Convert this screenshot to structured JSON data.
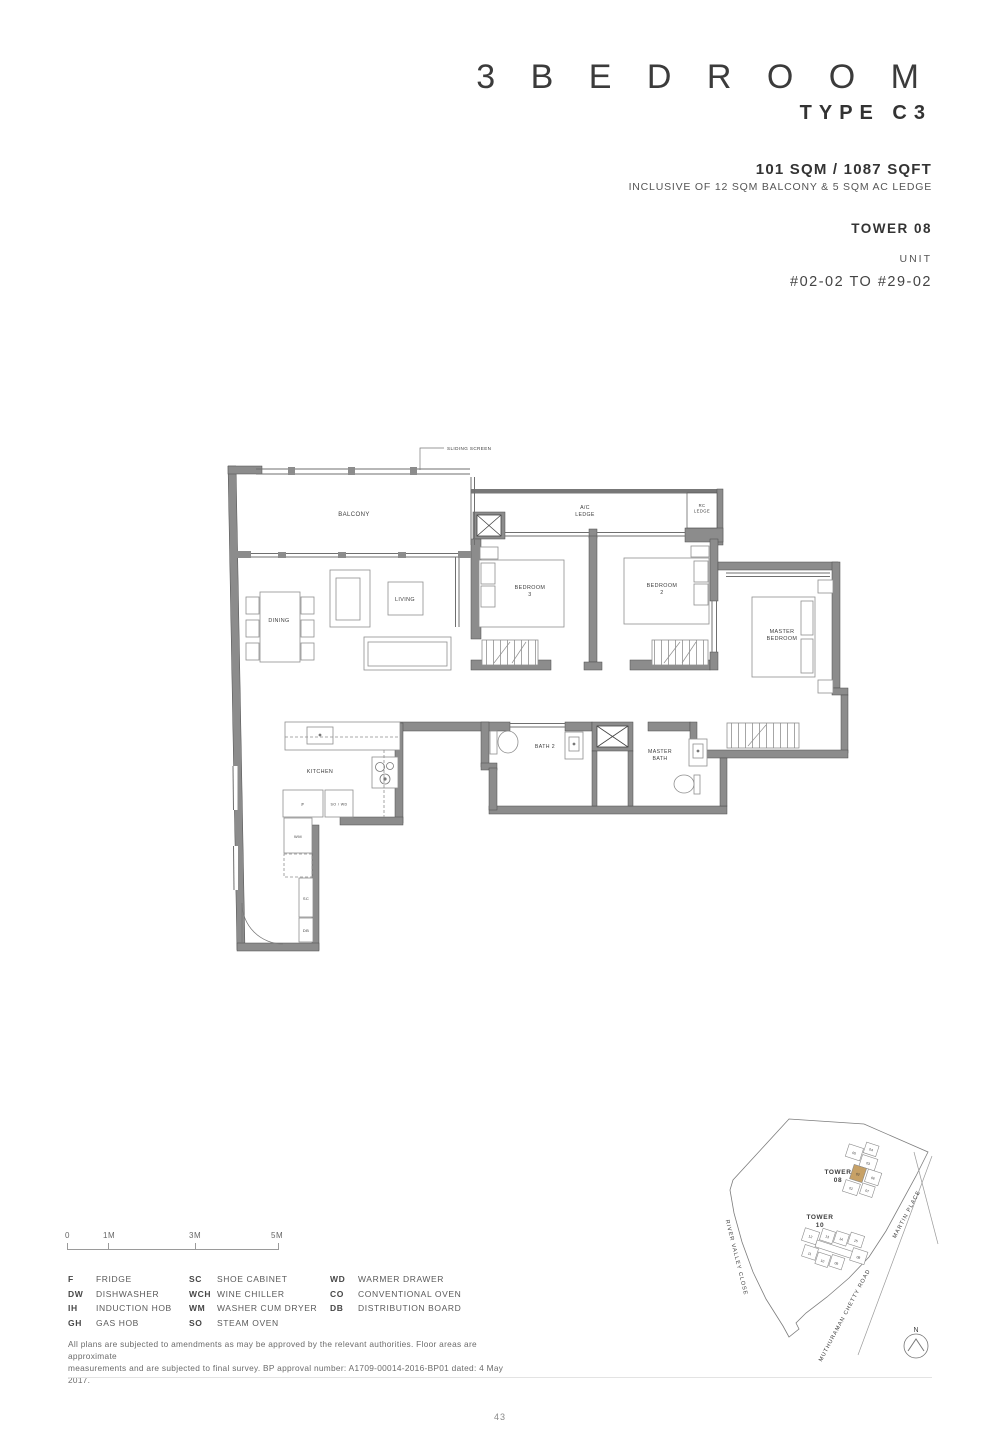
{
  "header": {
    "title": "3  B E D R O O M",
    "subtitle": "TYPE C3",
    "area": "101 SQM / 1087 SQFT",
    "inclusive": "INCLUSIVE OF 12 SQM BALCONY & 5 SQM AC LEDGE",
    "tower": "TOWER 08",
    "unit_label": "UNIT",
    "unit_range": "#02-02 TO #29-02"
  },
  "floorplan": {
    "labels": {
      "sliding_screen": "SLIDING SCREEN",
      "balcony": "BALCONY",
      "ac_ledge_l1": "A/C",
      "ac_ledge_l2": "LEDGE",
      "rc_ledge_l1": "RC",
      "rc_ledge_l2": "LEDGE",
      "dining": "DINING",
      "living": "LIVING",
      "bedroom3_l1": "BEDROOM",
      "bedroom3_l2": "3",
      "bedroom2_l1": "BEDROOM",
      "bedroom2_l2": "2",
      "master_l1": "MASTER",
      "master_l2": "BEDROOM",
      "kitchen": "KITCHEN",
      "bath2": "BATH 2",
      "masterbath_l1": "MASTER",
      "masterbath_l2": "BATH",
      "f": "F",
      "so_wd": "SO / WD",
      "wm": "WM",
      "sc": "SC",
      "db": "DB"
    }
  },
  "scalebar": {
    "ticks": [
      "0",
      "1M",
      "3M",
      "5M"
    ]
  },
  "legend": {
    "col1": [
      {
        "abbr": "F",
        "name": "FRIDGE"
      },
      {
        "abbr": "DW",
        "name": "DISHWASHER"
      },
      {
        "abbr": "IH",
        "name": "INDUCTION HOB"
      },
      {
        "abbr": "GH",
        "name": "GAS HOB"
      }
    ],
    "col2": [
      {
        "abbr": "SC",
        "name": "SHOE CABINET"
      },
      {
        "abbr": "WCH",
        "name": "WINE CHILLER"
      },
      {
        "abbr": "WM",
        "name": "WASHER CUM DRYER"
      },
      {
        "abbr": "SO",
        "name": "STEAM OVEN"
      }
    ],
    "col3": [
      {
        "abbr": "WD",
        "name": "WARMER DRAWER"
      },
      {
        "abbr": "CO",
        "name": "CONVENTIONAL OVEN"
      },
      {
        "abbr": "DB",
        "name": "DISTRIBUTION BOARD"
      }
    ]
  },
  "disclaimer": {
    "line1": "All plans are subjected to amendments as may be approved by the relevant authorities. Floor areas are approximate",
    "line2": "measurements and are subjected to final survey. BP approval number: A1709-00014-2016-BP01 dated: 4 May 2017."
  },
  "sitemap": {
    "tower08_l1": "TOWER",
    "tower08_l2": "08",
    "tower10_l1": "TOWER",
    "tower10_l2": "10",
    "road_river_valley": "RIVER VALLEY CLOSE",
    "road_muthuraman": "MUTHURAMAN CHETTY ROAD",
    "road_martin": "MARTIN PLACE",
    "north": "N",
    "highlight_color": "#c7a166",
    "t08_units": [
      "01",
      "02",
      "03",
      "04",
      "05",
      "06",
      "07"
    ],
    "t10_units": [
      "08",
      "09",
      "10",
      "11",
      "12",
      "13",
      "14",
      "15"
    ]
  },
  "page_number": "43"
}
